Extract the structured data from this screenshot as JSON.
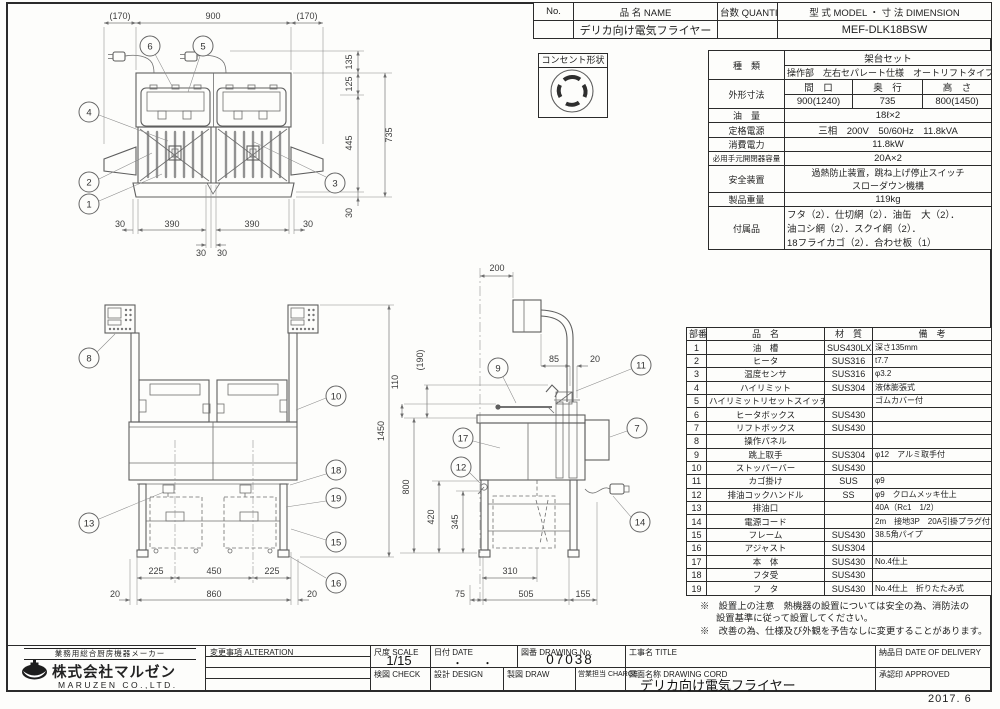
{
  "sheet": {
    "date_note": "2017. 6"
  },
  "header_table": {
    "cols": {
      "no": "No.",
      "name": "品 名 NAME",
      "qty": "台数 QUANTITY",
      "model": "型 式 MODEL ・ 寸 法 DIMENSION"
    },
    "row": {
      "no": "",
      "name": "デリカ向け電気フライヤー",
      "qty": "",
      "model": "MEF-DLK18BSW"
    }
  },
  "outlet": {
    "label": "コンセント形状"
  },
  "spec": {
    "kind_label": "種　類",
    "kind_line1": "架台セット",
    "kind_line2": "操作部　左右セパレート仕様　オートリフトタイプ",
    "dims_label": "外形寸法",
    "dims_cols": [
      "間　口",
      "奥　行",
      "高　さ"
    ],
    "dims_vals": [
      "900(1240)",
      "735",
      "800(1450)"
    ],
    "oil_label": "油　量",
    "oil_value": "18ℓ×2",
    "power_label": "定格電源",
    "power_value": "三相　200V　50/60Hz　11.8kVA",
    "consumption_label": "消費電力",
    "consumption_value": "11.8kW",
    "switch_label": "必用手元開閉器容量",
    "switch_value": "20A×2",
    "safety_label": "安全装置",
    "safety_line1": "過熱防止装置，跳ね上げ停止スイッチ",
    "safety_line2": "スローダウン機構",
    "weight_label": "製品重量",
    "weight_value": "119kg",
    "acc_label": "付属品",
    "acc_lines": [
      "フタ（2）．仕切網（2）．油缶　大（2）．",
      "油コシ網（2）．スクイ網（2）．",
      "18フライカゴ（2）．合わせ板（1）"
    ]
  },
  "parts": {
    "headers": [
      "部番",
      "品　名",
      "材　質",
      "備　考"
    ],
    "rows": [
      [
        "1",
        "油　槽",
        "SUS430LX",
        "深さ135mm"
      ],
      [
        "2",
        "ヒータ",
        "SUS316",
        "t7.7"
      ],
      [
        "3",
        "温度センサ",
        "SUS316",
        "φ3.2"
      ],
      [
        "4",
        "ハイリミット",
        "SUS304",
        "液体膨張式"
      ],
      [
        "5",
        "ハイリミットリセットスイッチ",
        "",
        "ゴムカバー付"
      ],
      [
        "6",
        "ヒータボックス",
        "SUS430",
        ""
      ],
      [
        "7",
        "リフトボックス",
        "SUS430",
        ""
      ],
      [
        "8",
        "操作パネル",
        "",
        ""
      ],
      [
        "9",
        "跳上取手",
        "SUS304",
        "φ12　アルミ取手付"
      ],
      [
        "10",
        "ストッパーバー",
        "SUS430",
        ""
      ],
      [
        "11",
        "カゴ掛け",
        "SUS",
        "φ9"
      ],
      [
        "12",
        "排油コックハンドル",
        "SS",
        "φ9　クロムメッキ仕上"
      ],
      [
        "13",
        "排油口",
        "",
        "40A（Rc1　1/2）"
      ],
      [
        "14",
        "電源コード",
        "",
        "2m　接地3P　20A引掛プラグ付"
      ],
      [
        "15",
        "フレーム",
        "SUS430",
        "38.5角パイプ"
      ],
      [
        "16",
        "アジャスト",
        "SUS304",
        ""
      ],
      [
        "17",
        "本　体",
        "SUS430",
        "No.4仕上"
      ],
      [
        "18",
        "フタ受",
        "SUS430",
        ""
      ],
      [
        "19",
        "フ　タ",
        "SUS430",
        "No.4仕上　折りたたみ式"
      ]
    ]
  },
  "notes": {
    "n1a": "※　設置上の注意　熱機器の設置については安全の為、消防法の",
    "n1b": "設置基準に従って設置してください。",
    "n2": "※　改善の為、仕様及び外観を予告なしに変更することがあります。"
  },
  "title_block": {
    "tagline": "業務用総合厨房機器メーカー",
    "company": "株式会社マルゼン",
    "company_en": "MARUZEN CO.,LTD.",
    "alteration_label": "変更事項  ALTERATION",
    "scale_label": "尺度  SCALE",
    "scale_value": "1/15",
    "date_label": "日付  DATE",
    "date_value": "・　　・",
    "check_label": "検図  CHECK",
    "design_label": "設計  DESIGN",
    "draw_label": "製図  DRAW",
    "dwg_no_label": "図番  DRAWING No.",
    "dwg_no_value": "07038",
    "charge_label": "営業担当  CHARGE",
    "title_label": "工事名  TITLE",
    "dwg_name_label": "図面名称  DRAWING CORD",
    "dwg_name_value": "デリカ向け電気フライヤー",
    "delivery_label": "納品日  DATE OF DELIVERY",
    "approved_label": "承認印  APPROVED"
  },
  "views": {
    "plan": {
      "balloons": {
        "b6": "6",
        "b5": "5",
        "b4": "4",
        "b2": "2",
        "b1": "1",
        "b3": "3"
      },
      "dims": {
        "top_left": "(170)",
        "top_center": "900",
        "top_right": "(170)",
        "r135": "135",
        "r125": "125",
        "r445": "445",
        "r30": "30",
        "r735": "735",
        "b30l": "30",
        "b390l": "390",
        "b390r": "390",
        "b30r": "30",
        "c30a": "30",
        "c30b": "30"
      }
    },
    "front": {
      "balloons": {
        "b8": "8",
        "b10": "10",
        "b13": "13",
        "b18": "18",
        "b19": "19",
        "b15": "15",
        "b16": "16"
      },
      "dims": {
        "d225l": "225",
        "d450": "450",
        "d225r": "225",
        "d20l": "20",
        "d860": "860",
        "d20r": "20",
        "d1450": "1450"
      }
    },
    "side": {
      "balloons": {
        "b9": "9",
        "b11": "11",
        "b7": "7",
        "b17": "17",
        "b12": "12",
        "b14": "14"
      },
      "dims": {
        "d200": "200",
        "d190": "(190)",
        "d110": "110",
        "d85": "85",
        "d20": "20",
        "d800": "800",
        "d420": "420",
        "d345": "345",
        "d310": "310",
        "d75": "75",
        "d505": "505",
        "d155": "155"
      }
    }
  }
}
